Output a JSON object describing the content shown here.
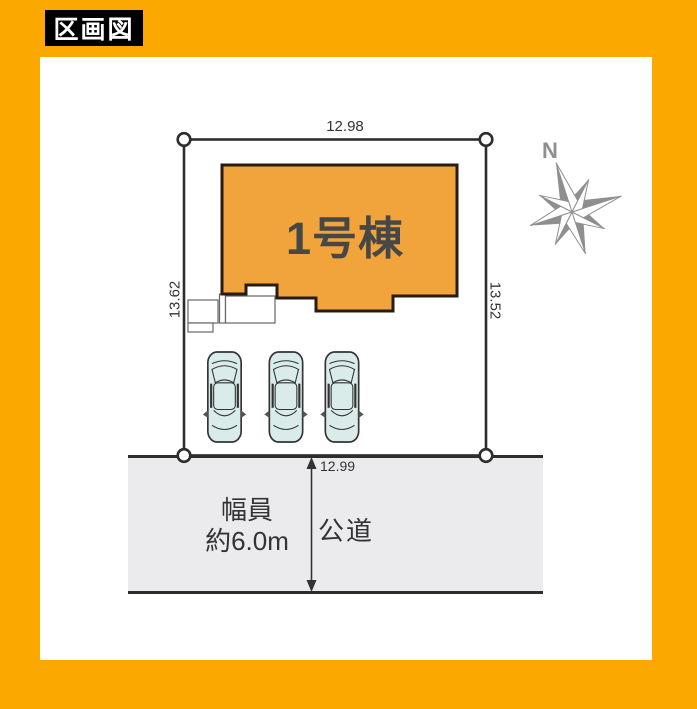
{
  "title_label": "区画図",
  "colors": {
    "frame": "#FBA800",
    "building": "#F1A43C",
    "building_outline": "#281C10",
    "car": "#D9ECEA",
    "road": "#EBEBEE",
    "line": "#2D2D2D",
    "text": "#333333",
    "compass": "#8F8F8F"
  },
  "site_plan": {
    "dimensions": {
      "top": "12.98",
      "left": "13.62",
      "right": "13.52",
      "bottom": "12.99"
    },
    "building": {
      "label": "1号棟"
    },
    "road": {
      "width_caption_line1": "幅員",
      "width_caption_line2": "約6.0m",
      "name": "公道"
    },
    "compass": {
      "north": "N"
    },
    "cars_count": 3
  }
}
